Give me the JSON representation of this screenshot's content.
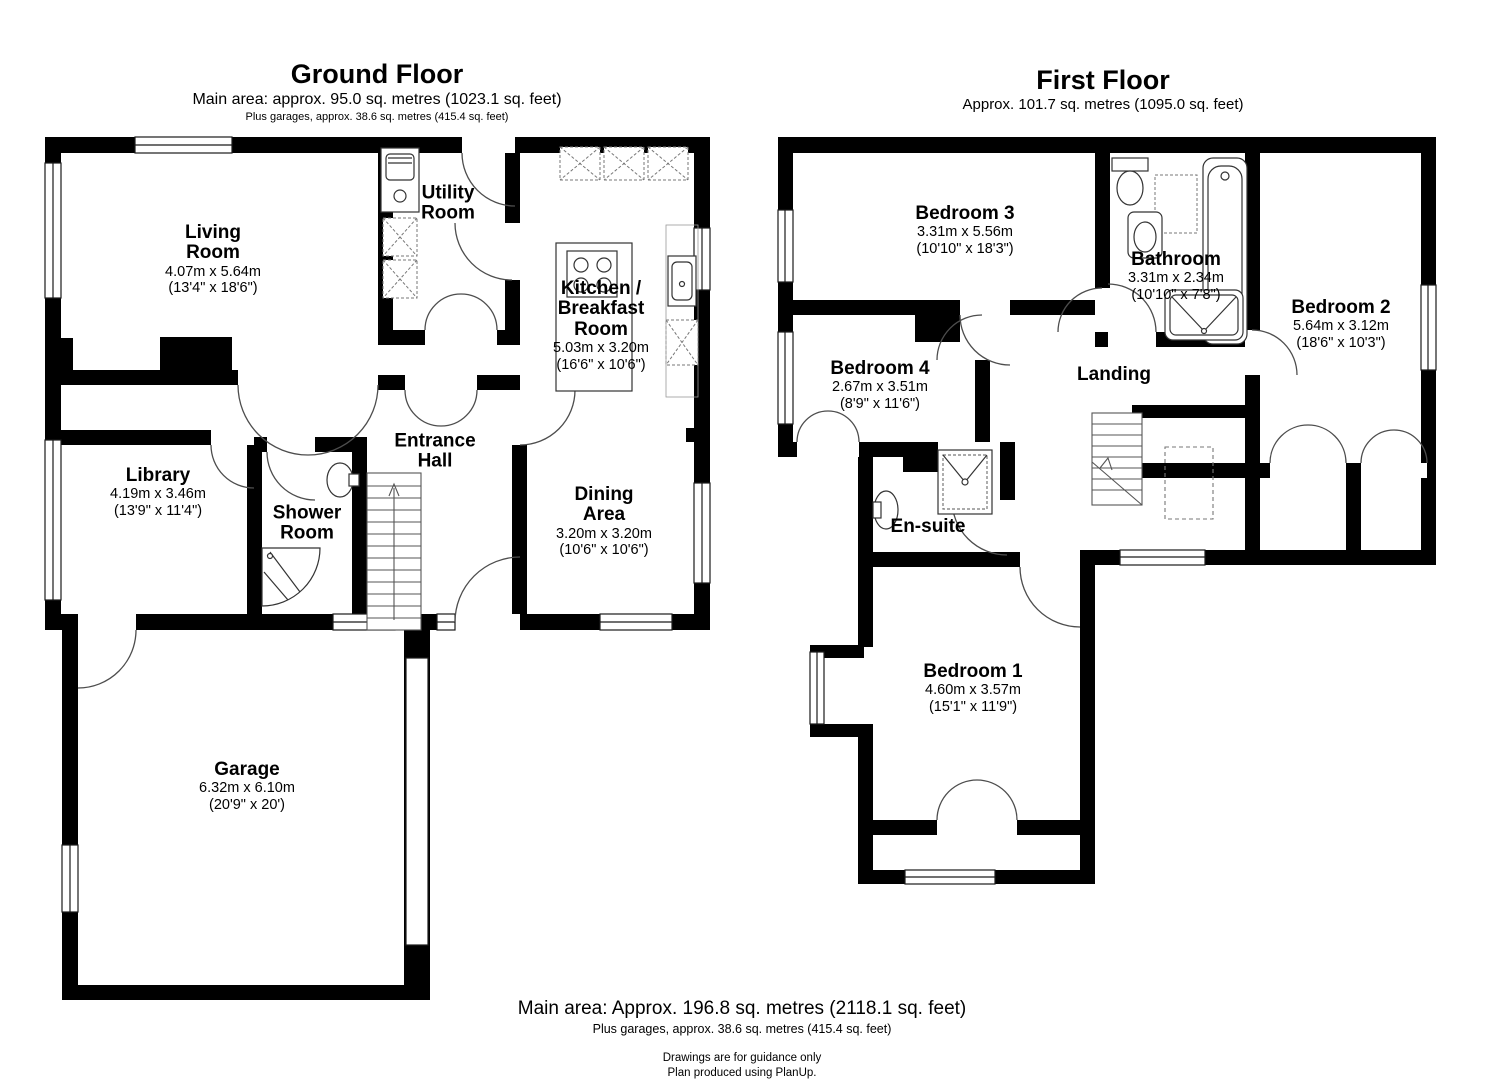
{
  "colors": {
    "wall": "#000000",
    "background": "#ffffff",
    "door_arc": "#4d4d4d",
    "fixture_line": "#333333",
    "counter_dash": "#777777"
  },
  "ground_floor": {
    "title": "Ground Floor",
    "subtitle": "Main area: approx. 95.0 sq. metres (1023.1 sq. feet)",
    "subtitle2": "Plus garages, approx. 38.6 sq. metres (415.4 sq. feet)",
    "rooms": [
      {
        "name": "Living\nRoom",
        "dims_m": "4.07m x 5.64m",
        "dims_ft": "(13'4\" x 18'6\")"
      },
      {
        "name": "Utility\nRoom",
        "dims_m": "",
        "dims_ft": ""
      },
      {
        "name": "Kitchen /\nBreakfast\nRoom",
        "dims_m": "5.03m x 3.20m",
        "dims_ft": "(16'6\" x 10'6\")"
      },
      {
        "name": "Entrance\nHall",
        "dims_m": "",
        "dims_ft": ""
      },
      {
        "name": "Library",
        "dims_m": "4.19m x 3.46m",
        "dims_ft": "(13'9\" x 11'4\")"
      },
      {
        "name": "Shower\nRoom",
        "dims_m": "",
        "dims_ft": ""
      },
      {
        "name": "Dining\nArea",
        "dims_m": "3.20m x 3.20m",
        "dims_ft": "(10'6\" x 10'6\")"
      },
      {
        "name": "Garage",
        "dims_m": "6.32m x 6.10m",
        "dims_ft": "(20'9\" x 20')"
      }
    ]
  },
  "first_floor": {
    "title": "First Floor",
    "subtitle": "Approx. 101.7 sq. metres (1095.0 sq. feet)",
    "rooms": [
      {
        "name": "Bedroom 3",
        "dims_m": "3.31m x 5.56m",
        "dims_ft": "(10'10\" x 18'3\")"
      },
      {
        "name": "Bathroom",
        "dims_m": "3.31m x 2.34m",
        "dims_ft": "(10'10\" x 7'8\")"
      },
      {
        "name": "Bedroom 2",
        "dims_m": "5.64m x 3.12m",
        "dims_ft": "(18'6\" x 10'3\")"
      },
      {
        "name": "Bedroom 4",
        "dims_m": "2.67m x 3.51m",
        "dims_ft": "(8'9\" x 11'6\")"
      },
      {
        "name": "Landing",
        "dims_m": "",
        "dims_ft": ""
      },
      {
        "name": "En-suite",
        "dims_m": "",
        "dims_ft": ""
      },
      {
        "name": "Bedroom 1",
        "dims_m": "4.60m x 3.57m",
        "dims_ft": "(15'1\" x 11'9\")"
      }
    ]
  },
  "footer": {
    "main_area": "Main area: Approx. 196.8 sq. metres (2118.1 sq. feet)",
    "garages": "Plus garages, approx. 38.6 sq. metres (415.4 sq. feet)",
    "guidance": "Drawings are for guidance only",
    "produced": "Plan produced using PlanUp."
  },
  "fixtures": [
    "staircase",
    "bathtub",
    "shower-tray",
    "toilet",
    "sink",
    "hob",
    "kitchen-island",
    "counter-units",
    "chimney-breast",
    "wardrobe-doors"
  ]
}
